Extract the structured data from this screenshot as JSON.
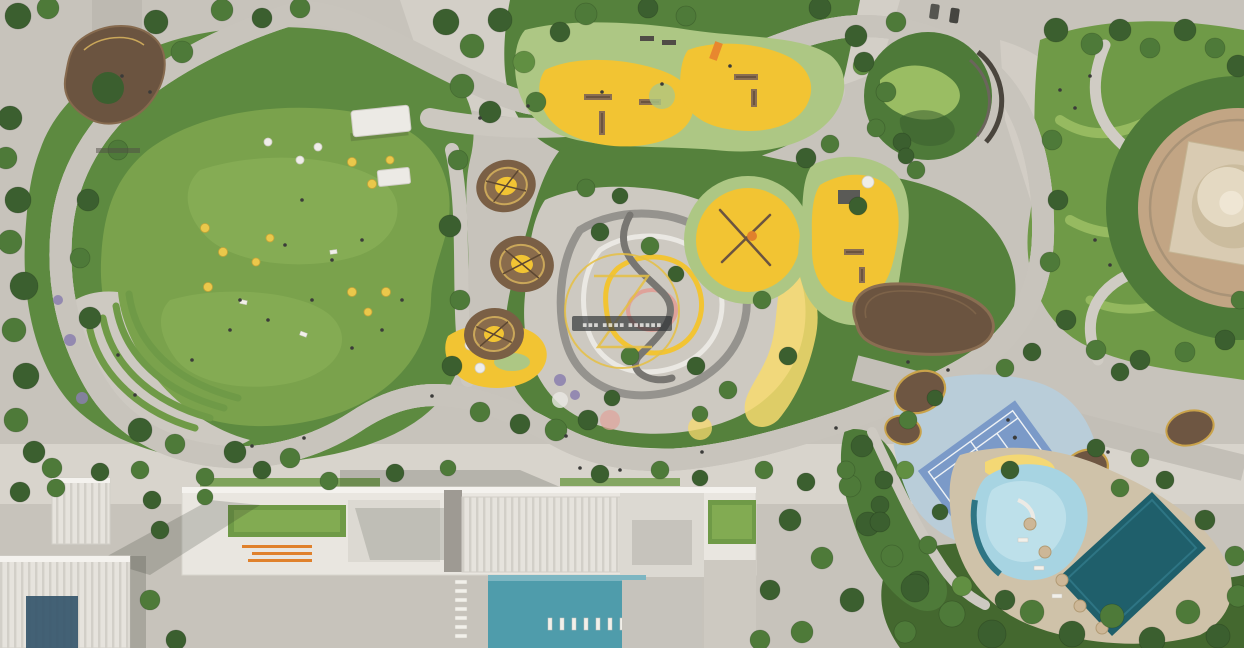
{
  "scene": {
    "kind": "aerial-masterplan-render",
    "label": "Top-down rendering of a landscaped city park with cycle loop, playgrounds, sports and pool courtyards"
  },
  "watermark": {
    "letter_glyph": "Z",
    "caption": "▪▪▪ ▪▪▪▪ ▪▪▪▪▪▪"
  },
  "colors": {
    "base": "#c7c3bb",
    "paving": "#cdc9c1",
    "lawn": "#7aa24c",
    "lawn_light": "#93b95f",
    "green_dark": "#3b5f2f",
    "green_mid": "#4e7a39",
    "rubber": "#adc784",
    "wave_light": "#a3c468",
    "loop": "#2f8ad2",
    "loop_edge": "#e8e6df",
    "play_yellow": "#f2c433",
    "play_yellow_light": "#f7da6e",
    "track_gray": "#95938e",
    "track_white": "#eae8e3",
    "track_pink": "#dfa29a",
    "timber": "#6b5440",
    "gold_rim": "#c9a24a",
    "tennis_pad": "#b9cdd9",
    "tennis_court": "#7b9ac8",
    "court_line": "#eef2f5",
    "pool_teal": "#4f9cab",
    "pool_deep": "#1f5f6b",
    "pool_kids": "#a7d4e2",
    "deck_tan": "#cfc2a9",
    "building_white": "#e9e6e0",
    "building_gray": "#c6c3bc",
    "glass_blue": "#35566b",
    "plaza_tan": "#c2a584",
    "dome": "#d9cbb2",
    "orange_marks": "#e0812c",
    "watermark": "#e6c043",
    "banner": "#2b2f33",
    "banner_text": "#d8d8d6"
  },
  "features": {
    "great_lawn": {
      "label": "Great lawn"
    },
    "terraces": {
      "label": "Lawn terraces"
    },
    "loop": {
      "label": "Cycle loop trail"
    },
    "north_playground": {
      "label": "Adventure playground"
    },
    "central_playground": {
      "label": "Round playground"
    },
    "east_playground": {
      "label": "Climbing playground"
    },
    "toddler_playground": {
      "label": "Toddler play area"
    },
    "climbing_bowls": {
      "label": "Nest climbing bowls"
    },
    "pump_track": {
      "label": "Pump track hills"
    },
    "canopy": {
      "label": "Canopy pavilion"
    },
    "entrance_pavilion": {
      "label": "Entrance pavilion"
    },
    "lawn_pavilion": {
      "label": "Lawn pavilion"
    },
    "wavy_garden": {
      "label": "Pattern garden"
    },
    "hill_garden": {
      "label": "Hill garden"
    },
    "rotunda": {
      "label": "Rotunda plaza"
    },
    "tennis": {
      "label": "Tennis court"
    },
    "kids_pool": {
      "label": "Kids splash pool"
    },
    "lap_pool": {
      "label": "Outdoor lap pool"
    },
    "roof_pool": {
      "label": "Courtyard pool"
    },
    "residential": {
      "label": "Residential block"
    },
    "towers": {
      "label": "Residential towers"
    },
    "promenade": {
      "label": "South promenade"
    },
    "street": {
      "label": "West street"
    },
    "forest": {
      "label": "South-east grove"
    }
  }
}
